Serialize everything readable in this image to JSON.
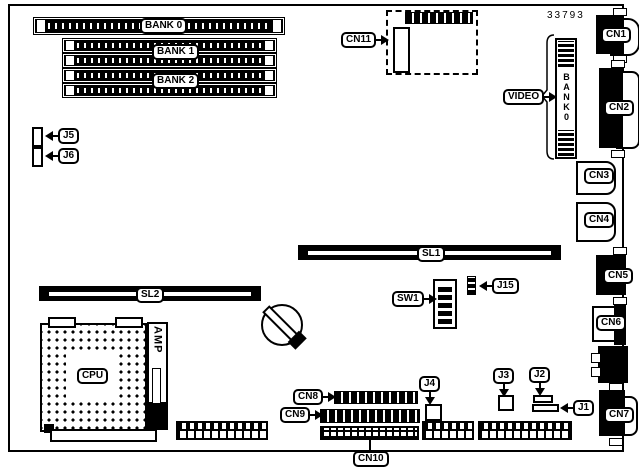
{
  "part_number": "33793",
  "banks": {
    "bank0": "BANK 0",
    "bank1": "BANK 1",
    "bank2": "BANK 2"
  },
  "video": {
    "label": "VIDEO",
    "slot_text": "BANK0"
  },
  "cpu": "CPU",
  "amp": "AMP",
  "slots": {
    "sl1": "SL1",
    "sl2": "SL2"
  },
  "switches": {
    "sw1": "SW1"
  },
  "connectors": {
    "cn1": "CN1",
    "cn2": "CN2",
    "cn3": "CN3",
    "cn4": "CN4",
    "cn5": "CN5",
    "cn6": "CN6",
    "cn7": "CN7",
    "cn8": "CN8",
    "cn9": "CN9",
    "cn10": "CN10",
    "cn11": "CN11"
  },
  "jumpers": {
    "j1": "J1",
    "j2": "J2",
    "j3": "J3",
    "j4": "J4",
    "j5": "J5",
    "j6": "J6",
    "j15": "J15"
  },
  "colors": {
    "line": "#000000",
    "bg": "#ffffff"
  }
}
